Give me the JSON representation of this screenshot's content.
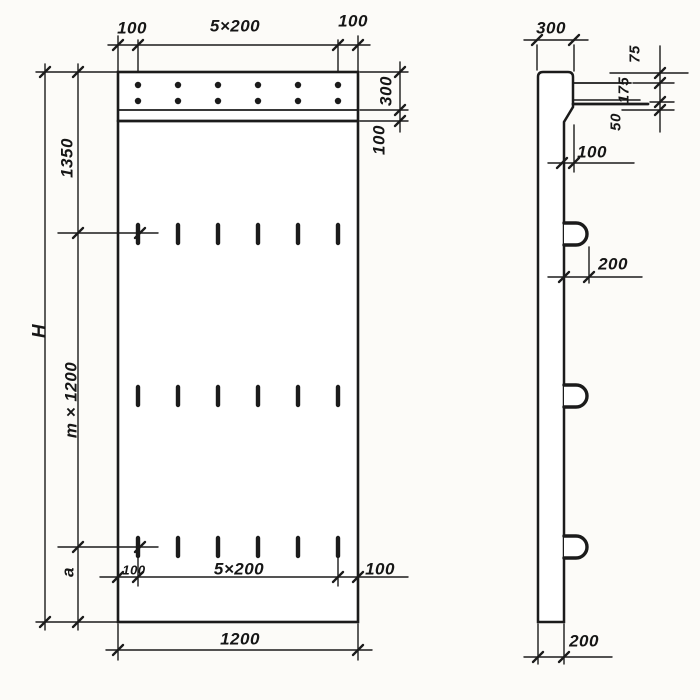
{
  "drawing": {
    "kind": "technical-drawing",
    "subject": "Precast concrete wall panel with anchor band and lifting loops, front and side views",
    "ink_color": "#1b1b1b",
    "paper_color": "#fcfbf8"
  },
  "views": {
    "front": {
      "top_chain": {
        "left": "100",
        "middle": "5×200",
        "right": "100"
      },
      "band": {
        "height": "300",
        "offset": "100"
      },
      "height_chain": {
        "overall": "H",
        "top": "1350",
        "middle": "m × 1200",
        "bottom": "a"
      },
      "slot_chain": {
        "left": "100",
        "middle": "5×200",
        "right": "100"
      },
      "overall_width": "1200"
    },
    "side": {
      "top_width": "300",
      "edge_chain": {
        "top": "75",
        "middle": "175",
        "bottom": "50"
      },
      "step": "100",
      "loop_projection": "200",
      "bottom_width": "200"
    }
  }
}
